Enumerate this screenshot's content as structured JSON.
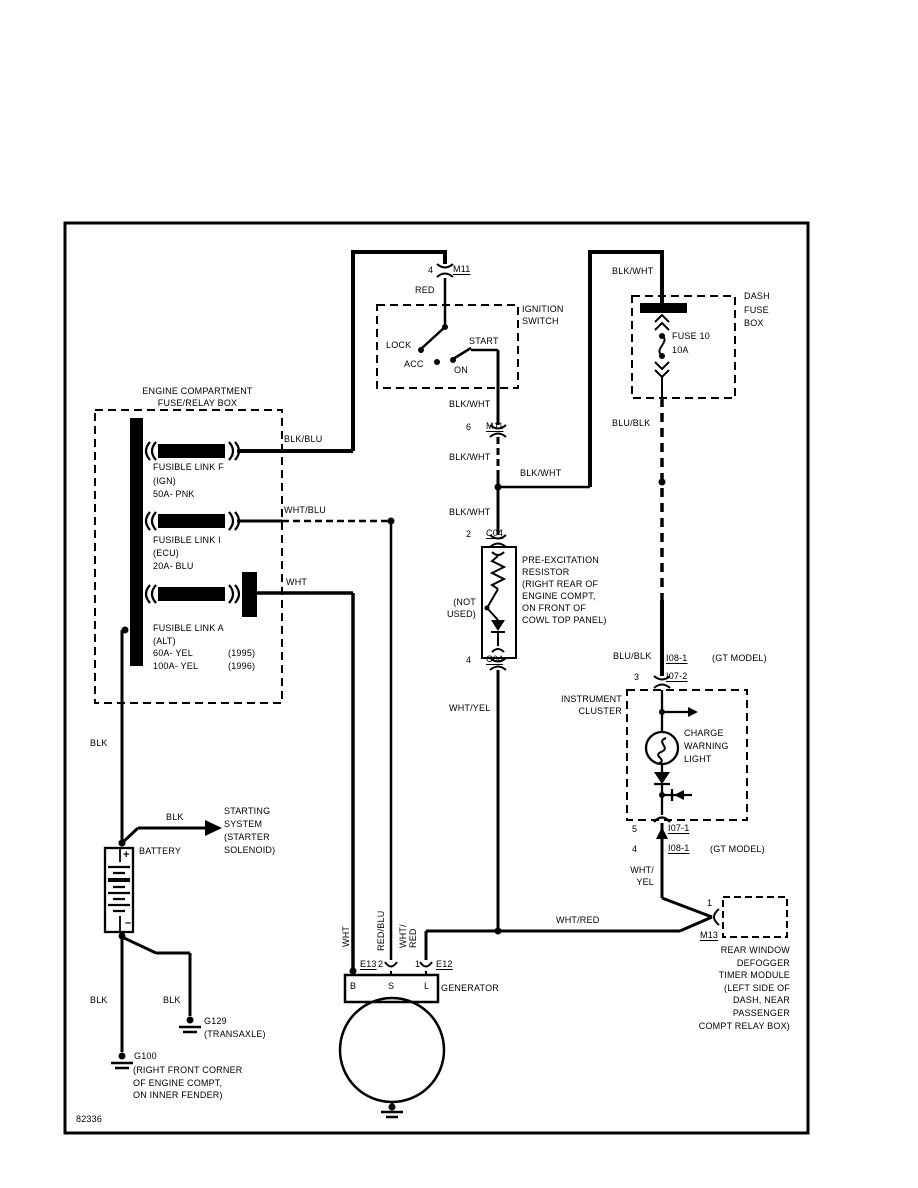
{
  "doc": {
    "number": "82336"
  },
  "colors": {
    "ink": "#000000",
    "paper": "#ffffff"
  },
  "wire": {
    "blk_wht": "BLK/WHT",
    "blk_blu": "BLK/BLU",
    "wht_blu": "WHT/BLU",
    "wht": "WHT",
    "red": "RED",
    "blk": "BLK",
    "blu_blk": "BLU/BLK",
    "wht_yel": "WHT/YEL",
    "wht_yel_wrap": "WHT/\nYEL",
    "wht_red": "WHT/RED",
    "red_blu": "RED/BLU",
    "wht_red_wrap": "WHT/\nRED"
  },
  "connector": {
    "m11": "M11",
    "c04": "C04",
    "i07_2": "I07-2",
    "i08_1": "I08-1",
    "i07_1": "I07-1",
    "m13": "M13",
    "e13": "E13",
    "e12": "E12"
  },
  "pin": {
    "p1": "1",
    "p2": "2",
    "p3": "3",
    "p4": "4",
    "p5": "5",
    "p6": "6"
  },
  "gt_model": "(GT MODEL)",
  "ignition": {
    "title": "IGNITION\nSWITCH",
    "lock": "LOCK",
    "acc": "ACC",
    "start": "START",
    "on": "ON"
  },
  "dash_fuse": {
    "title": "DASH\nFUSE\nBOX",
    "fuse": "FUSE 10",
    "amps": "10A"
  },
  "engine_box": {
    "title": "ENGINE COMPARTMENT\nFUSE/RELAY BOX",
    "link_f": "FUSIBLE LINK F\n(IGN)\n50A- PNK",
    "link_i": "FUSIBLE LINK I\n(ECU)\n20A- BLU",
    "link_a": "FUSIBLE LINK A\n(ALT)",
    "link_a_1995": "60A- YEL",
    "y1995": "(1995)",
    "link_a_1996": "100A- YEL",
    "y1996": "(1996)"
  },
  "resistor": {
    "desc": "PRE-EXCITATION\nRESISTOR\n(RIGHT REAR OF\nENGINE COMPT,\nON FRONT OF\nCOWL TOP PANEL)",
    "not_used": "(NOT\nUSED)"
  },
  "cluster": {
    "title": "INSTRUMENT\nCLUSTER",
    "charge": "CHARGE\nWARNING\nLIGHT"
  },
  "battery": {
    "label": "BATTERY",
    "plus": "+",
    "minus": "–",
    "starting": "STARTING\nSYSTEM\n(STARTER\nSOLENOID)"
  },
  "generator": {
    "label": "GENERATOR",
    "b": "B",
    "s": "S",
    "l": "L"
  },
  "grounds": {
    "g100": "G100",
    "g100_loc": "(RIGHT FRONT CORNER\nOF ENGINE COMPT,\nON INNER FENDER)",
    "g129": "G129",
    "g129_loc": "(TRANSAXLE)"
  },
  "defogger": {
    "desc": "REAR WINDOW\nDEFOGGER\nTIMER MODULE\n(LEFT SIDE OF\nDASH, NEAR\nPASSENGER\nCOMPT RELAY BOX)"
  }
}
